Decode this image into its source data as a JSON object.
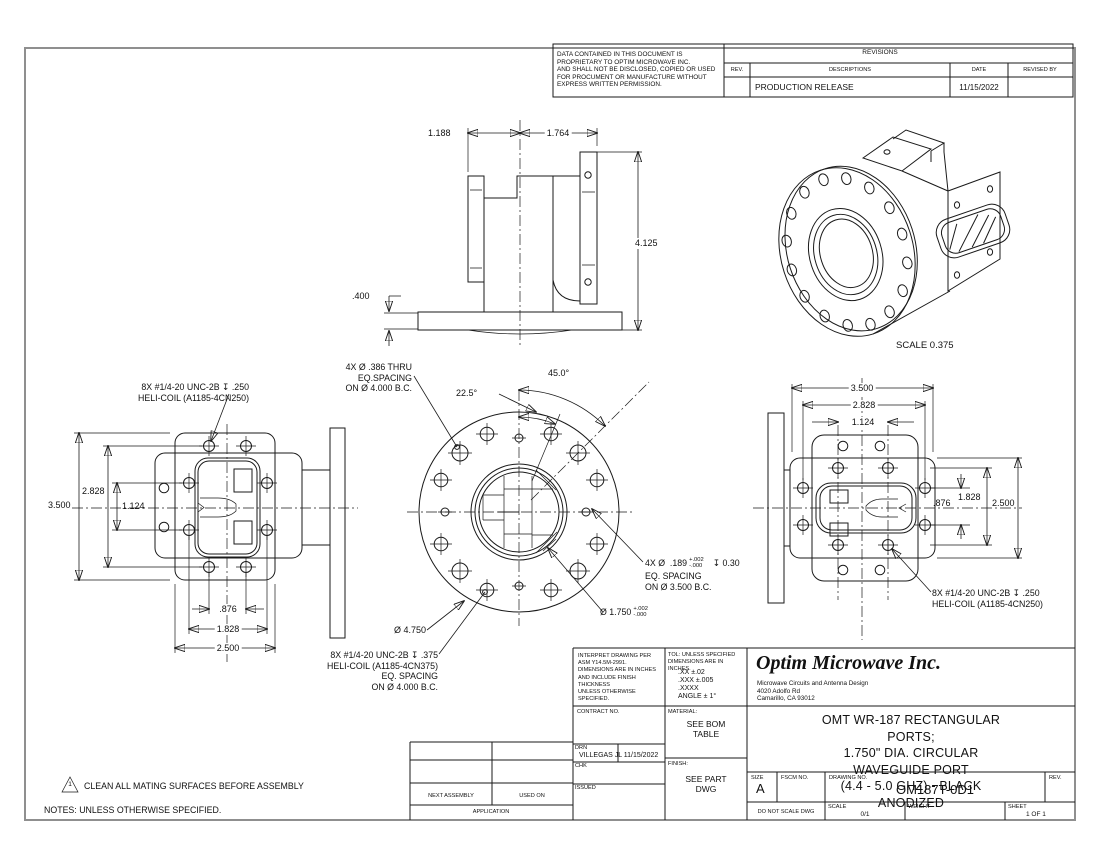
{
  "proprietary": {
    "text": "DATA CONTAINED IN THIS DOCUMENT IS\nPROPRIETARY TO OPTIM MICROWAVE INC.\nAND SHALL NOT BE DISCLOSED, COPIED OR USED\nFOR PROCUMENT OR MANUFACTURE WITHOUT\nEXPRESS WRITTEN PERMISSION."
  },
  "revisions": {
    "title": "REVISIONS",
    "col_rev": "REV.",
    "col_desc": "DESCRIPTIONS",
    "col_date": "DATE",
    "col_revised": "REVISED BY",
    "row_desc": "PRODUCTION RELEASE",
    "row_date": "11/15/2022"
  },
  "front_view": {
    "d_left": "1.188",
    "d_right": "1.764",
    "d_height": "4.125",
    "d_base": ".400"
  },
  "iso_view": {
    "scale_label": "SCALE  0.375"
  },
  "left_view": {
    "callout": "8X #1/4-20 UNC-2B ↧ .250\nHELI-COIL (A1185-4CN250)",
    "v_outer": "3.500",
    "v_mid": "2.828",
    "v_inner": "1.124",
    "h_inner": ".876",
    "h_mid": "1.828",
    "h_outer": "2.500"
  },
  "center_view": {
    "thru_callout": "4X Ø .386 THRU\nEQ.SPACING\nON Ø 4.000 B.C.",
    "angle_small": "22.5°",
    "angle_large": "45.0°",
    "pin_prefix": "4X Ø  .189",
    "pin_tol_plus": "+.002",
    "pin_tol_minus": "-.000",
    "pin_suffix": "↧ 0.30",
    "pin_line2": "EQ. SPACING",
    "pin_line3": "ON Ø 3.500 B.C.",
    "bore_prefix": "Ø 1.750",
    "bore_tol_plus": "+.002",
    "bore_tol_minus": "-.000",
    "flange_dia": "Ø 4.750",
    "heli_callout": "8X #1/4-20 UNC-2B ↧ .375\nHELI-COIL (A1185-4CN375)\nEQ. SPACING\nON Ø 4.000 B.C."
  },
  "right_view": {
    "h_outer": "3.500",
    "h_mid": "2.828",
    "h_inner": "1.124",
    "v_mid": "1.828",
    "v_inner": ".876",
    "v_outer": "2.500",
    "callout": "8X #1/4-20 UNC-2B ↧ .250\nHELI-COIL (A1185-4CN250)"
  },
  "notes": {
    "flag_number": "1",
    "flag_note": "CLEAN ALL MATING SURFACES BEFORE ASSEMBLY",
    "header": "NOTES: UNLESS OTHERWISE SPECIFIED."
  },
  "title_block": {
    "interpret": "INTERPRET DRAWING PER\nASM Y14.5M-2991.\nDIMENSIONS ARE IN INCHES\nAND INCLUDE FINISH\nTHICKNESS\nUNLESS OTHERWISE SPECIFIED.",
    "tol_header": "TOL: UNLESS SPECIFIED\nDIMENSIONS ARE IN INCHES.",
    "tol_body": ".XX  ±.02\n.XXX  ±.005\n.XXXX\nANGLE ± 1°",
    "contract_label": "CONTRACT NO.",
    "material_label": "MATERIAL:",
    "material_value": "SEE BOM\nTABLE",
    "finish_label": "FINISH:",
    "finish_value": "SEE PART\nDWG",
    "drn_label": "DRN",
    "drn_name": "VILLEGAS JL",
    "drn_date": "11/15/2022",
    "chk_label": "CHK",
    "issued_label": "ISSUED",
    "company": "Optim Microwave Inc.",
    "tagline": "Microwave Circuits and Antenna Design",
    "address1": "4020 Adolfo Rd",
    "address2": "Camarillo, CA 93012",
    "title": "OMT WR-187 RECTANGULAR PORTS;\n1.750\" DIA. CIRCULAR WAVEGUIDE PORT\n(4.4 - 5.0 GHZ) - BLACK ANODIZED",
    "size_label": "SIZE",
    "size_value": "A",
    "fscm_label": "FSCM NO.",
    "dwg_label": "DRAWING NO.",
    "dwg_number": "OM187T-0D1",
    "rev_label": "REV.",
    "no_scale": "DO NOT SCALE DWG",
    "scale_label": "SCALE",
    "scale_value": "0/1",
    "weight_label": "WEIGHT",
    "sheet_label": "SHEET",
    "sheet_value": "1 OF 1",
    "next_assembly": "NEXT ASSEMBLY",
    "used_on": "USED ON",
    "application": "APPLICATION"
  }
}
